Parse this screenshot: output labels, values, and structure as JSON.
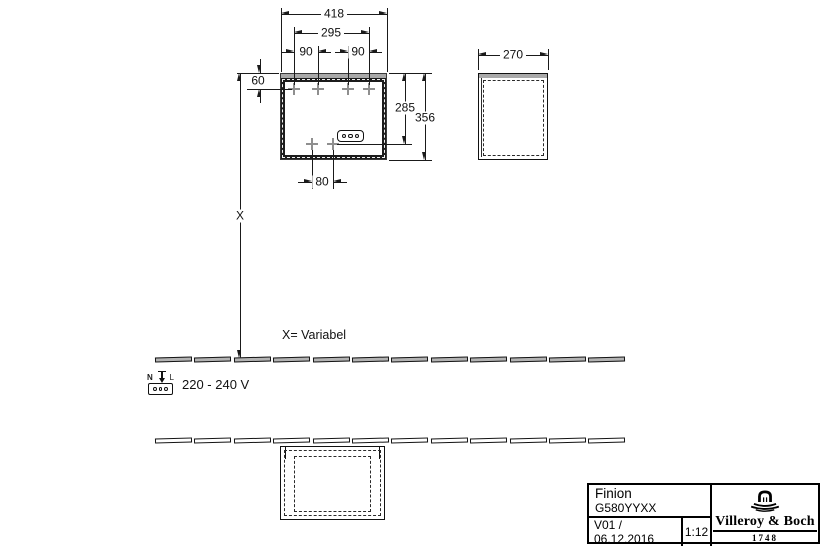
{
  "drawing": {
    "front_view": {
      "dim_width_total": "418",
      "dim_hole_span": "295",
      "dim_hole_spacing_left": "90",
      "dim_hole_spacing_right": "90",
      "dim_top_offset": "60",
      "dim_height_to_socket": "285",
      "dim_height_total": "356",
      "dim_bottom_hole_spacing": "80",
      "dim_mount_height": "X"
    },
    "side_view": {
      "dim_depth": "270"
    },
    "notes": {
      "variable": "X= Variabel",
      "power": "220 - 240 V",
      "terminal_left": "N",
      "terminal_right": "L"
    }
  },
  "title_block": {
    "product": "Finion",
    "article": "G580YYXX",
    "version_date": "V01 / 06.12.2016",
    "scale": "1:12",
    "brand_name": "Villeroy & Boch",
    "brand_year": "1748"
  },
  "colors": {
    "line": "#1a1a1a",
    "panel_gray": "#a9a9a9",
    "tile_gray": "#b3b3b3",
    "cross_gray": "#8f8f8f"
  }
}
